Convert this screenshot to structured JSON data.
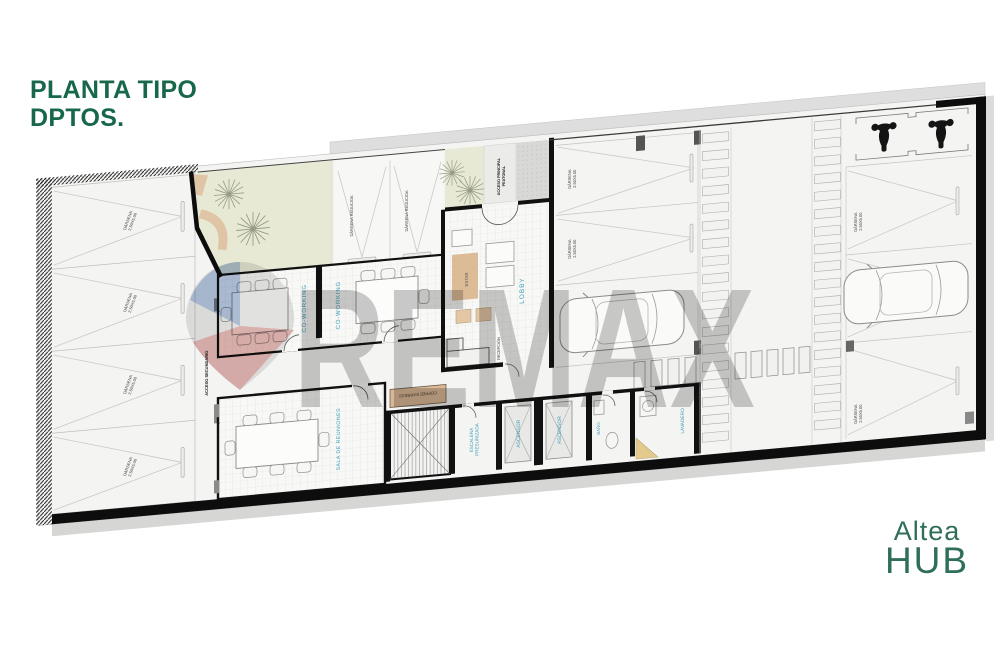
{
  "header": {
    "title_line1": "PLANTA TIPO",
    "title_line2": "DPTOS."
  },
  "brand": {
    "line1": "Altea",
    "line2": "HUB"
  },
  "watermark": {
    "text": "REMAX"
  },
  "plan": {
    "rooms": {
      "coworking": "CO-WORKING",
      "lobby": "LOBBY",
      "estar": "ESTAR",
      "recepcion": "RECEPCIÓN",
      "sala_reuniones": "SALA DE REUNIONES",
      "coffee_express": "COFFEE EXPRESS",
      "escalera_line1": "ESCALERA",
      "escalera_line2": "PRESURIZADA",
      "ascensor": "ASCENSOR",
      "banio": "BAÑO",
      "lavadero": "LAVADERO"
    },
    "accesos": {
      "secundario": "ACCESO SECUNDARIO",
      "principal_line1": "ACCESO PRINCIPAL",
      "principal_line2": "PEATONAL"
    },
    "parking": {
      "darsena": "DÁRSENA",
      "darsena_size": "2.50X5.00",
      "darsena_reducida": "DÁRSENA REDUCIDA"
    },
    "colors": {
      "title_green": "#17684a",
      "brand_green": "#2f6e57",
      "label_blue": "#3e9fb6",
      "garden_green": "#e7e9d4",
      "path_beige": "#dfc5a6",
      "wall_black": "#0d0d0d",
      "watermark_gray": "#8c8c8c",
      "balloon_blue": "#4a6fa5",
      "balloon_red": "#b4544c"
    }
  }
}
